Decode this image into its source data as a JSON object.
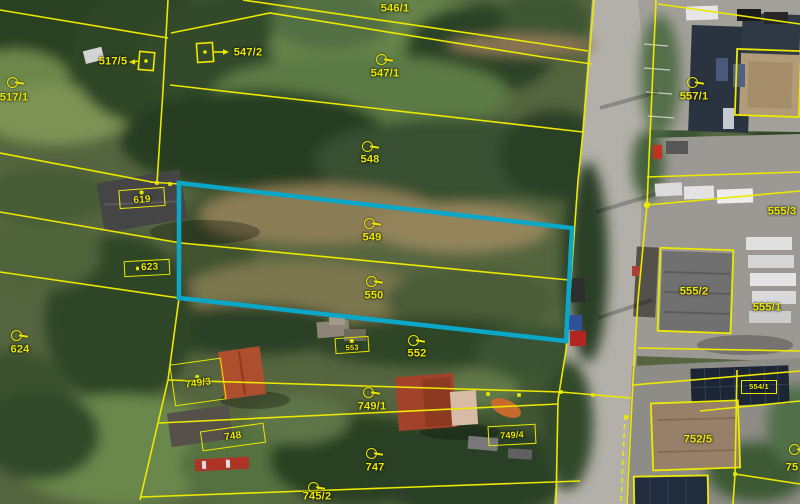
{
  "map": {
    "description": "aerial-cadastral-map-view",
    "colors": {
      "parcel_line": "#ece800",
      "label_text": "#ece800",
      "highlight_outline": "#0aa7c9",
      "road_surface": "#b3b0a9"
    },
    "selected_parcels": [
      "549",
      "550"
    ],
    "symbols": {
      "circle": "unbuilt-parcel-marker",
      "box": "building-parcel-label-box",
      "square-arrow": "building-symbol-with-arrow"
    },
    "labels": [
      {
        "text": "517/1",
        "symbol": "circle",
        "x": 14,
        "y": 98,
        "cx": 12,
        "cy": 82
      },
      {
        "text": "517/5",
        "symbol": "square-arrow",
        "x": 113,
        "y": 62
      },
      {
        "text": "547/2",
        "symbol": "square-arrow",
        "x": 248,
        "y": 53
      },
      {
        "text": "546/1",
        "symbol": "none",
        "x": 395,
        "y": 9
      },
      {
        "text": "547/1",
        "symbol": "circle",
        "x": 385,
        "y": 74,
        "cx": 381,
        "cy": 59
      },
      {
        "text": "557/1",
        "symbol": "circle",
        "x": 694,
        "y": 97,
        "cx": 692,
        "cy": 82
      },
      {
        "text": "548",
        "symbol": "circle",
        "x": 370,
        "y": 160,
        "cx": 367,
        "cy": 146
      },
      {
        "text": "619",
        "symbol": "box",
        "x": 142,
        "y": 198,
        "w": 46,
        "h": 19,
        "rot": -4,
        "dot": "top",
        "fs": 10
      },
      {
        "text": "549",
        "symbol": "circle",
        "x": 372,
        "y": 238,
        "cx": 369,
        "cy": 223
      },
      {
        "text": "623",
        "symbol": "box",
        "x": 147,
        "y": 268,
        "w": 46,
        "h": 16,
        "rot": -3,
        "dot": "left",
        "fs": 10
      },
      {
        "text": "550",
        "symbol": "circle",
        "x": 374,
        "y": 296,
        "cx": 371,
        "cy": 281
      },
      {
        "text": "555/3",
        "symbol": "none",
        "x": 782,
        "y": 212
      },
      {
        "text": "624",
        "symbol": "circle",
        "x": 20,
        "y": 350,
        "cx": 16,
        "cy": 335
      },
      {
        "text": "553",
        "symbol": "box",
        "x": 352,
        "y": 345,
        "w": 34,
        "h": 16,
        "rot": -4,
        "dot": "top",
        "fs": 7.5
      },
      {
        "text": "552",
        "symbol": "circle",
        "x": 417,
        "y": 354,
        "cx": 413,
        "cy": 340
      },
      {
        "text": "555/2",
        "symbol": "none",
        "x": 694,
        "y": 292
      },
      {
        "text": "555/1",
        "symbol": "none",
        "x": 767,
        "y": 308
      },
      {
        "text": "749/3",
        "symbol": "box",
        "x": 198,
        "y": 382,
        "w": 52,
        "h": 42,
        "rot": -8,
        "dot": "top",
        "fs": 10
      },
      {
        "text": "749/1",
        "symbol": "circle",
        "x": 372,
        "y": 407,
        "cx": 368,
        "cy": 392
      },
      {
        "text": "748",
        "symbol": "box",
        "x": 233,
        "y": 437,
        "w": 64,
        "h": 20,
        "rot": -8,
        "fs": 10
      },
      {
        "text": "749/4",
        "symbol": "box",
        "x": 512,
        "y": 435,
        "w": 48,
        "h": 20,
        "rot": -3,
        "fs": 9
      },
      {
        "text": "554/1",
        "symbol": "box",
        "x": 759,
        "y": 387,
        "w": 36,
        "h": 14,
        "rot": 0,
        "fs": 7.5
      },
      {
        "text": "752/5",
        "symbol": "none",
        "x": 698,
        "y": 440
      },
      {
        "text": "747",
        "symbol": "circle",
        "x": 375,
        "y": 468,
        "cx": 371,
        "cy": 453
      },
      {
        "text": "745/2",
        "symbol": "circle",
        "x": 317,
        "y": 497,
        "cx": 313,
        "cy": 487
      },
      {
        "text": "75",
        "symbol": "circle",
        "x": 792,
        "y": 468,
        "cx": 794,
        "cy": 449
      }
    ]
  }
}
